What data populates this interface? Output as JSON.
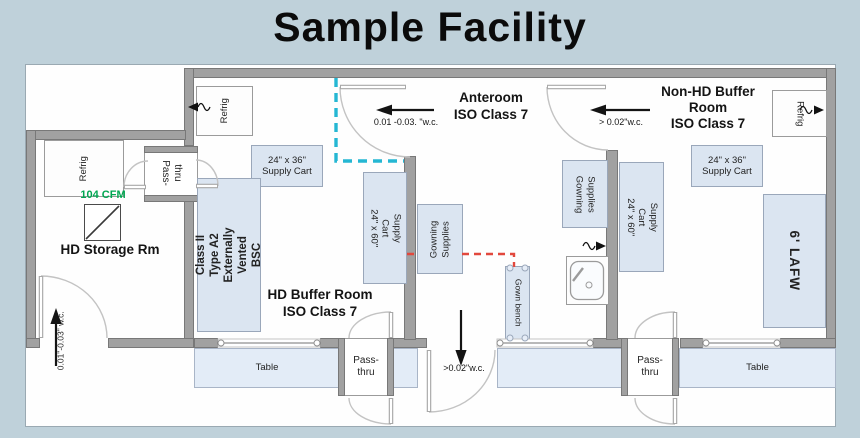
{
  "title": "Sample Facility",
  "colors": {
    "background": "#bfd1da",
    "wall": "#a1a1a1",
    "equipment_fill": "#dbe5f1",
    "iso_boundary_dashed": "#25b7d3",
    "gowning_path_dashed": "#e2483d",
    "exhaust_green": "#00a651"
  },
  "rooms": {
    "hd_storage": {
      "name": "HD Storage Rm"
    },
    "hd_buffer": {
      "line1": "HD Buffer Room",
      "line2": "ISO Class 7"
    },
    "anteroom": {
      "line1": "Anteroom",
      "line2": "ISO Class 7"
    },
    "non_hd_buffer": {
      "line1": "Non-HD Buffer",
      "line2": "Room",
      "line3": "ISO Class 7"
    }
  },
  "airflow": {
    "hd_buffer_door": "0.01 -0.03. \"w.c.",
    "non_hd_door": "> 0.02\"w.c.",
    "anteroom_exit": ">0.02\"w.c.",
    "hd_storage_door": "0.01\"-0.03\" w.c.",
    "exhaust_rate": "104 CFM"
  },
  "equipment": {
    "refrig_storage": {
      "label": "Refrig"
    },
    "refrig_hd": {
      "label": "Refrig"
    },
    "refrig_nonhd": {
      "label": "Refrig"
    },
    "bsc": {
      "line1": "Class II",
      "line2": "Type A2 Externally",
      "line3": "Vented BSC"
    },
    "cart36_hd": {
      "line1": "24\" x 36\"",
      "line2": "Supply Cart"
    },
    "cart60_hd": {
      "line1": "24\" x 60\"",
      "line2": "Supply Cart"
    },
    "cart36_nonhd": {
      "line1": "24\" x 36\"",
      "line2": "Supply Cart"
    },
    "cart60_nonhd": {
      "line1": "24\" x 60\"",
      "line2": "Supply Cart"
    },
    "gowning_anteroom_west": {
      "line1": "Gowning",
      "line2": "Supplies"
    },
    "gowning_anteroom_east": {
      "line1": "Gowning",
      "line2": "Supplies"
    },
    "gown_bench": {
      "label": "Gown bench"
    },
    "lafw": {
      "label": "6' LAFW"
    },
    "table_hd": {
      "label": "Table"
    },
    "table_nonhd": {
      "label": "Table"
    },
    "pass_thru_storage": {
      "line1": "Pass-",
      "line2": "thru"
    },
    "pass_thru_hd": {
      "line1": "Pass-",
      "line2": "thru"
    },
    "pass_thru_nonhd": {
      "line1": "Pass-",
      "line2": "thru"
    }
  }
}
